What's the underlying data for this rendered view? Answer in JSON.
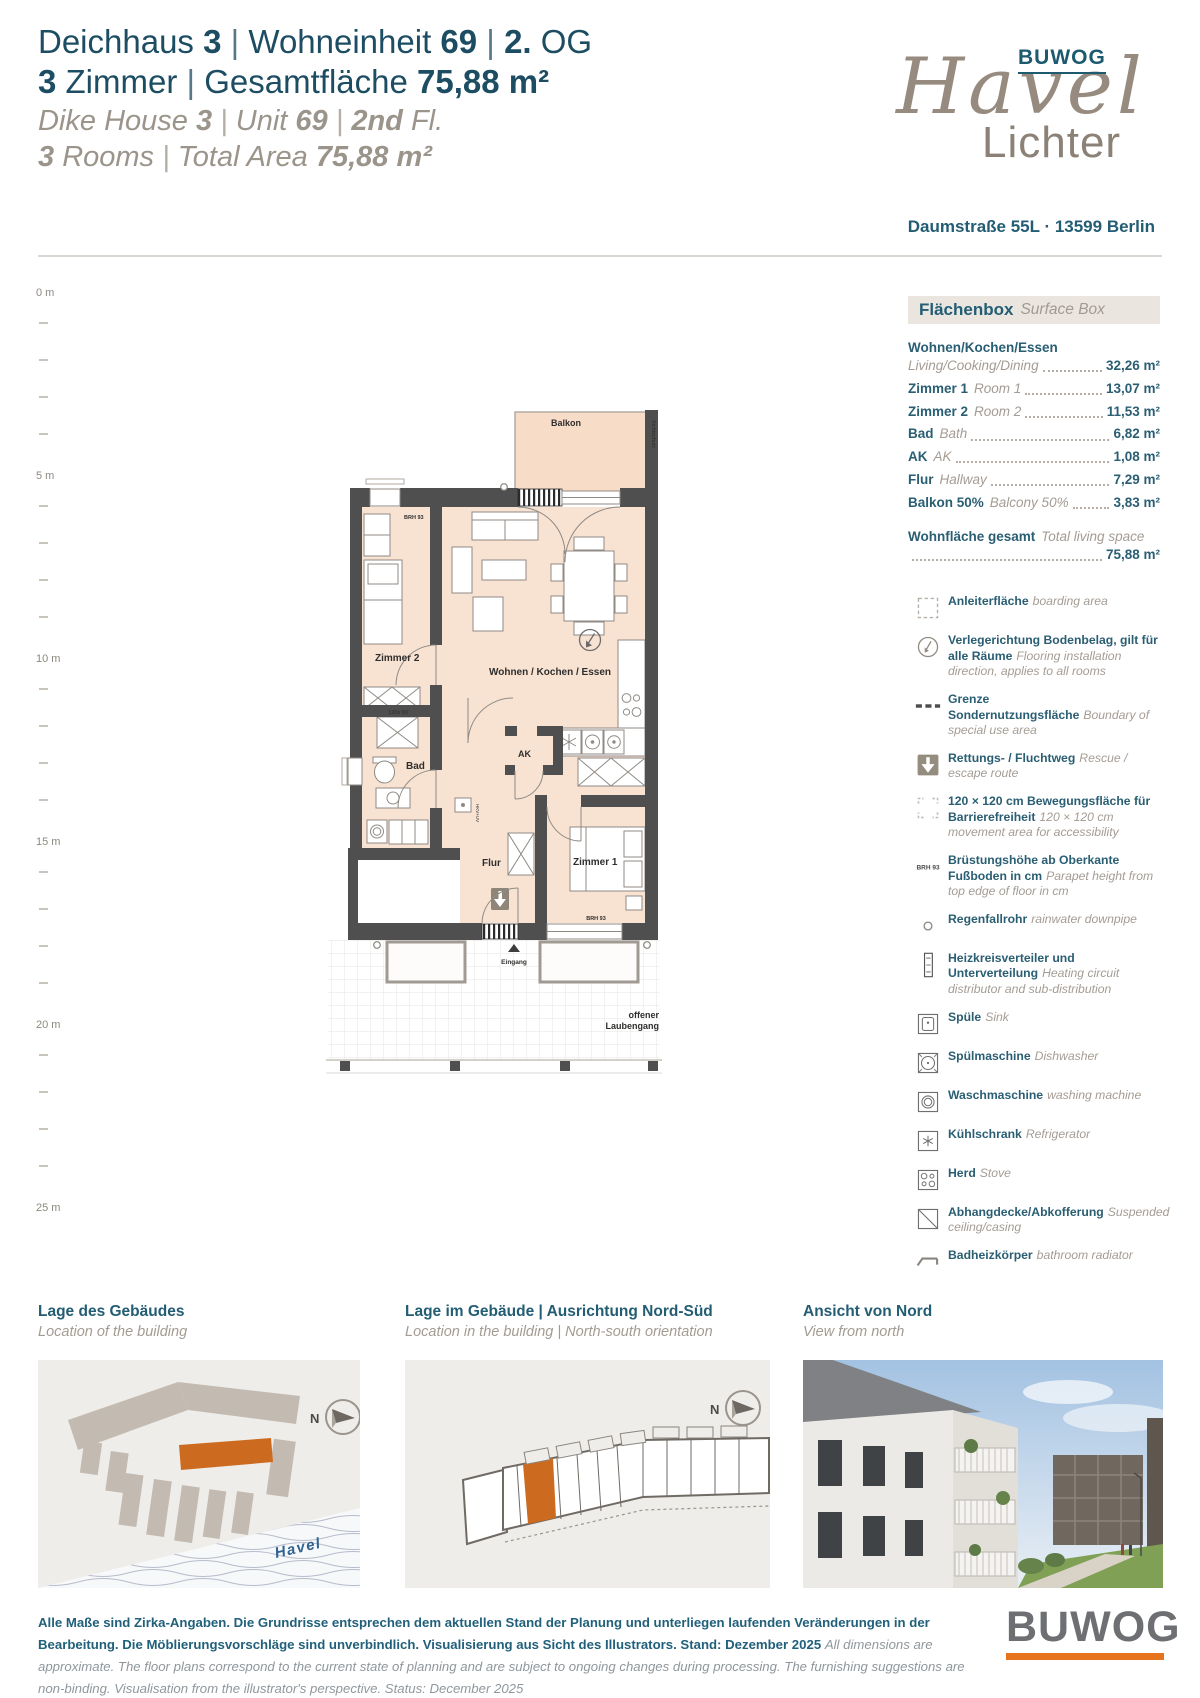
{
  "header": {
    "title_lines": [
      {
        "_class": "de",
        "segments": [
          {
            "text": "Deichhaus ",
            "style": "l"
          },
          {
            "text": "3",
            "style": "b"
          },
          {
            "text": "  |  ",
            "style": "p"
          },
          {
            "text": "Wohneinheit ",
            "style": "l"
          },
          {
            "text": "69",
            "style": "b"
          },
          {
            "text": "  |  ",
            "style": "p"
          },
          {
            "text": "2.",
            "style": "b"
          },
          {
            "text": " OG",
            "style": "l"
          }
        ]
      },
      {
        "_class": "de",
        "segments": [
          {
            "text": "3",
            "style": "b"
          },
          {
            "text": " Zimmer",
            "style": "l"
          },
          {
            "text": "  |  ",
            "style": "p"
          },
          {
            "text": "Gesamtfläche ",
            "style": "l"
          },
          {
            "text": "75,88 m²",
            "style": "b"
          }
        ]
      },
      {
        "_class": "en",
        "segments": [
          {
            "text": "Dike House ",
            "style": "l"
          },
          {
            "text": "3",
            "style": "b"
          },
          {
            "text": "  |  ",
            "style": "p"
          },
          {
            "text": "Unit ",
            "style": "l"
          },
          {
            "text": "69",
            "style": "b"
          },
          {
            "text": "  |  ",
            "style": "p"
          },
          {
            "text": "2nd",
            "style": "b"
          },
          {
            "text": " Fl.",
            "style": "l"
          }
        ]
      },
      {
        "_class": "en",
        "segments": [
          {
            "text": "3",
            "style": "b"
          },
          {
            "text": " Rooms",
            "style": "l"
          },
          {
            "text": "  |  ",
            "style": "p"
          },
          {
            "text": "Total Area ",
            "style": "l"
          },
          {
            "text": "75,88 m²",
            "style": "b"
          }
        ]
      }
    ],
    "logo": {
      "buwog": "BUWOG",
      "script": "Havel",
      "sub": "Lichter"
    },
    "address": "Daumstraße 55L · 13599 Berlin"
  },
  "ruler": {
    "segments": [
      {
        "label": "0 m"
      },
      {
        "label": "5 m"
      },
      {
        "label": "10 m"
      },
      {
        "label": "15 m"
      },
      {
        "label": "20 m"
      },
      {
        "label": "25 m",
        "_class": "no-ticks"
      }
    ]
  },
  "floorplan": {
    "balkon": "Balkon",
    "sichtschutz": "Sichtschutz",
    "zimmer2": "Zimmer 2",
    "wohnen": "Wohnen / Kochen / Essen",
    "bad": "Bad",
    "ak": "AK",
    "flur": "Flur",
    "zimmer1": "Zimmer 1",
    "eingang": "Eingang",
    "laubengang_1": "offener",
    "laubengang_2": "Laubengang",
    "brh": "BRH 93",
    "shower_size": "120x 90",
    "hkv": "HKV+UV"
  },
  "surface_box": {
    "title_de": "Flächenbox",
    "title_en": "Surface Box",
    "areas": [
      {
        "de": "Wohnen/Kochen/Essen",
        "en": "Living/Cooking/Dining",
        "value": "32,26 m²",
        "_class": "two-line"
      },
      {
        "de": "Zimmer 1",
        "en": "Room 1",
        "value": "13,07 m²"
      },
      {
        "de": "Zimmer 2",
        "en": "Room 2",
        "value": "11,53 m²"
      },
      {
        "de": "Bad",
        "en": "Bath",
        "value": "6,82 m²"
      },
      {
        "de": "AK",
        "en": "AK",
        "value": "1,08 m²"
      },
      {
        "de": "Flur",
        "en": "Hallway",
        "value": "7,29 m²"
      },
      {
        "de": "Balkon 50%",
        "en": "Balcony 50%",
        "value": "3,83 m²"
      }
    ],
    "total": {
      "de": "Wohnfläche gesamt",
      "en": "Total living space",
      "value": "75,88 m²",
      "_class": "two-line"
    }
  },
  "legend": {
    "brh_icon_text": "BRH 93",
    "items": [
      {
        "icon": "ic-anleiter",
        "de": "Anleiterfläche",
        "en": "boarding area"
      },
      {
        "icon": "ic-direction",
        "de": "Verlegerichtung Bodenbelag, gilt für alle Räume",
        "en": "Flooring installation direction, applies to all rooms"
      },
      {
        "icon": "ic-grenze",
        "de": "Grenze Sondernutzungsfläche",
        "en": "Boundary of special use area"
      },
      {
        "icon": "ic-rescue",
        "de": "Rettungs- / Fluchtweg",
        "en": "Rescue / escape route"
      },
      {
        "icon": "ic-move",
        "de": "120 × 120 cm Bewegungsfläche für Barrierefreiheit",
        "en": "120 × 120 cm movement area for accessibility"
      },
      {
        "icon": "ic-brh",
        "de": "Brüstungshöhe ab Oberkante Fußboden in cm",
        "en": "Parapet height from top edge of floor in cm"
      },
      {
        "icon": "ic-pipe",
        "de": "Regenfallrohr",
        "en": "rainwater downpipe"
      },
      {
        "icon": "ic-hkv",
        "de": "Heizkreisverteiler und Unterverteilung",
        "en": "Heating circuit distributor and sub-distribution"
      },
      {
        "icon": "ic-sink",
        "de": "Spüle",
        "en": "Sink"
      },
      {
        "icon": "ic-dish",
        "de": "Spülmaschine",
        "en": "Dishwasher"
      },
      {
        "icon": "ic-wash",
        "de": "Waschmaschine",
        "en": "washing machine"
      },
      {
        "icon": "ic-fridge",
        "de": "Kühlschrank",
        "en": "Refrigerator"
      },
      {
        "icon": "ic-stove",
        "de": "Herd",
        "en": "Stove"
      },
      {
        "icon": "ic-ceiling",
        "de": "Abhangdecke/Abkofferung",
        "en": "Suspended ceiling/casing"
      },
      {
        "icon": "ic-radiator",
        "de": "Badheizkörper",
        "en": "bathroom radiator"
      }
    ]
  },
  "panels": {
    "compass_n": "N",
    "havel_label": "Havel",
    "p1": {
      "title_de": "Lage des Gebäudes",
      "title_en": "Location of the building"
    },
    "p2": {
      "title_de": "Lage im Gebäude | Ausrichtung Nord-Süd",
      "title_en": "Location in the building | North-south orientation"
    },
    "p3": {
      "title_de": "Ansicht von Nord",
      "title_en": "View from north"
    }
  },
  "footer": {
    "de": "Alle Maße sind Zirka-Angaben. Die Grundrisse entsprechen dem aktuellen Stand der Planung und unterliegen laufenden Veränderungen in der Bearbeitung. Die Möblierungsvorschläge sind unverbindlich. Visualisierung aus Sicht des Illustrators. Stand: Dezember 2025 ",
    "en": "All dimensions are approximate. The floor plans correspond to the current state of planning and are subject to ongoing changes during processing. The furnishing suggestions are non-binding. Visualisation from the illustrator's perspective. Status: December 2025",
    "logo": "BUWOG"
  }
}
